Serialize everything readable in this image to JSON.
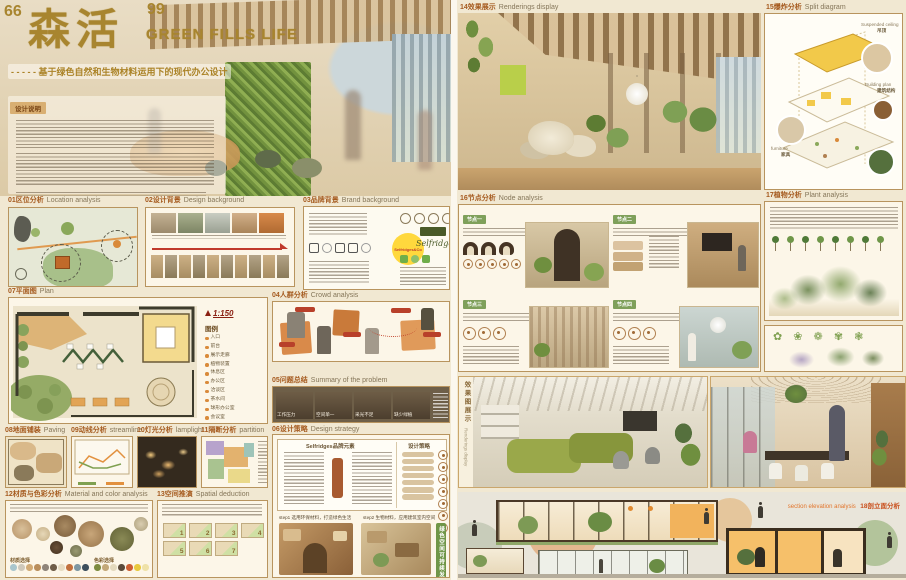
{
  "title": {
    "open_quote": "66",
    "cn": "森活",
    "close_quote": "99",
    "en": "GREEN FILLS LIFE",
    "dash": "- - - - -",
    "subtitle": "基于绿色自然和生物材料运用下的现代办公设计"
  },
  "design_note": {
    "label": "设计说明"
  },
  "sections": {
    "s01": {
      "num": "01",
      "cn": "区位分析",
      "en": "Location analysis"
    },
    "s02": {
      "num": "02",
      "cn": "设计背景",
      "en": "Design background"
    },
    "s03": {
      "num": "03",
      "cn": "品牌背景",
      "en": "Brand background"
    },
    "s04": {
      "num": "04",
      "cn": "人群分析",
      "en": "Crowd analysis"
    },
    "s05": {
      "num": "05",
      "cn": "问题总结",
      "en": "Summary of the problem"
    },
    "s06": {
      "num": "06",
      "cn": "设计策略",
      "en": "Design strategy"
    },
    "s07": {
      "num": "07",
      "cn": "平面图",
      "en": "Plan"
    },
    "s08": {
      "num": "08",
      "cn": "地面铺装",
      "en": "Paving"
    },
    "s09": {
      "num": "09",
      "cn": "动线分析",
      "en": "streamline"
    },
    "s10": {
      "num": "10",
      "cn": "灯光分析",
      "en": "lamplight"
    },
    "s11": {
      "num": "11",
      "cn": "隔断分析",
      "en": "partition"
    },
    "s12": {
      "num": "12",
      "cn": "材质与色彩分析",
      "en": "Material and color analysis"
    },
    "s13": {
      "num": "13",
      "cn": "空间推演",
      "en": "Spatial deduction"
    },
    "s14": {
      "num": "14",
      "cn": "效果展示",
      "en": "Renderings display"
    },
    "s15": {
      "num": "15",
      "cn": "爆炸分析",
      "en": "Split diagram"
    },
    "s16": {
      "num": "16",
      "cn": "节点分析",
      "en": "Node analysis"
    },
    "s17": {
      "num": "17",
      "cn": "植物分析",
      "en": "Plant analysis"
    },
    "s18": {
      "num": "18",
      "cn": "剖立面分析",
      "en": "section elevation analysis"
    }
  },
  "plan": {
    "scale": "1:150",
    "legend_title": "图例",
    "legend": [
      "入口",
      "前台",
      "展示走廊",
      "植物装置",
      "休息区",
      "办公区",
      "洽谈区",
      "茶水间",
      "球形办公室",
      "会议室",
      "出口"
    ]
  },
  "brand": {
    "badge": "Selfridges&Co",
    "script": "Selfridges"
  },
  "problems": [
    "工作压力",
    "空间单一",
    "采光不足",
    "缺少绿植"
  ],
  "strategy": {
    "left_title": "Selfridges品牌元素",
    "right_title": "设计策略",
    "step1": "step1 选用环保材料，打造绿色生活",
    "step2": "step2 生物材料，应用建筑室内空间",
    "side_tag": "绿色空间可持续发展"
  },
  "materials": {
    "material_label": "材质选择",
    "color_label": "色彩选择",
    "material_dots": [
      "#a9c6cd",
      "#cfc9bb",
      "#d2ab76",
      "#b98e5c",
      "#8f857a",
      "#6f5d48",
      "#e7dcc2",
      "#c2703d",
      "#7e97a2",
      "#3d4f5c"
    ],
    "color_dots": [
      "#7d8b3f",
      "#c3a878",
      "#e3d9bd",
      "#5a4a3a",
      "#cd5f32",
      "#e8c93e",
      "#efe2a8"
    ]
  },
  "deduction": {
    "steps": [
      "1",
      "2",
      "3",
      "4",
      "5",
      "6",
      "7"
    ]
  },
  "split": {
    "l1_en": "Suspended ceiling",
    "l1_cn": "吊顶",
    "l2_en": "Building plan",
    "l2_cn": "建筑结构",
    "l3_en": "furniture",
    "l3_cn": "家具"
  },
  "nodes": {
    "t1": "节点一",
    "t2": "节点二",
    "t3": "节点三",
    "t4": "节点四"
  },
  "renderings_vertical": {
    "cn": "效果图展示",
    "en": "Renderings display"
  },
  "plants": {
    "plant_glyphs": "✿ ❀ ❁ ✾ ❃"
  }
}
